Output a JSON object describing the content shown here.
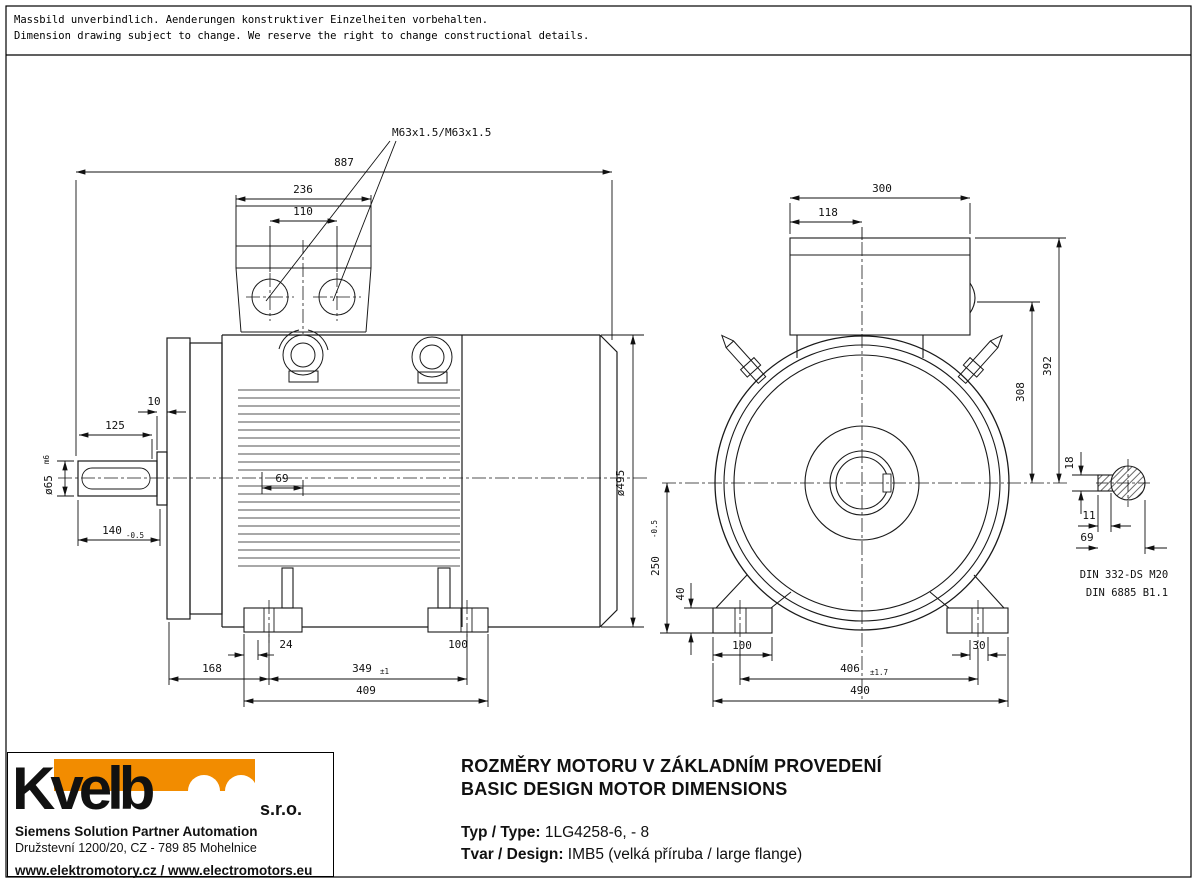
{
  "disclaimer": {
    "line1": "Massbild unverbindlich. Aenderungen konstruktiver Einzelheiten vorbehalten.",
    "line2": "Dimension drawing subject to change. We reserve the right to change constructional details."
  },
  "drawing": {
    "gland_label": "M63x1.5/M63x1.5",
    "din_center_bore": "DIN 332-DS M20",
    "din_key": "DIN 6885 B1.1",
    "dims": {
      "overall_length": "887",
      "tbox_top_width": "236",
      "gland_spacing": "110",
      "hub_protrusion": "10",
      "shaft_usable_length": "125",
      "shaft_diameter": "ø65",
      "shaft_diameter_tol": "m6",
      "shaft_length": "140",
      "shaft_length_tol": "-0.5",
      "fin_start_offset": "69",
      "flange_to_foot_hole": "168",
      "foot_pad_offset": "24",
      "foot_hole_span_side": "349",
      "foot_hole_span_side_tol": "±1",
      "foot_pad_width_side": "100",
      "foot_overall_side": "409",
      "frame_diameter": "ø495",
      "tbox_depth": "300",
      "tbox_offset": "118",
      "tbox_top_height": "392",
      "gland_height": "308",
      "key_section_height": "18",
      "key_width": "11",
      "key_length": "69",
      "shaft_height": "250",
      "shaft_height_tol": "-0.5",
      "foot_pad_height": "40",
      "foot_pad_width_front": "100",
      "foot_pad_inner": "30",
      "foot_hole_span_front": "406",
      "foot_hole_span_front_tol": "±1.7",
      "foot_overall_front": "490"
    }
  },
  "logo": {
    "wordmark": "Kvelb",
    "suffix": "s.r.o.",
    "line1": "Siemens Solution Partner Automation",
    "line2": "Družstevní 1200/20, CZ - 789 85 Mohelnice",
    "line3": "www.elektromotory.cz / www.electromotors.eu"
  },
  "title_block": {
    "title_cs": "ROZMĚRY MOTORU V ZÁKLADNÍM PROVEDENÍ",
    "title_en": "BASIC DESIGN MOTOR DIMENSIONS",
    "type_label": "Typ / Type:",
    "type_value": " 1LG4258-6, - 8",
    "design_label": "Tvar / Design:",
    "design_value": " IMB5 (velká příruba / large flange)"
  },
  "colors": {
    "orange": "#F28C00",
    "dark_gray": "#4A4D4E"
  }
}
